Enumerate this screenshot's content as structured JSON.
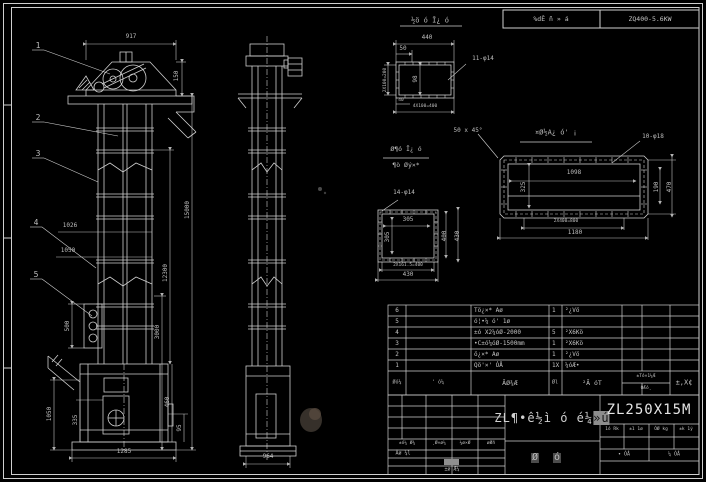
{
  "colors": {
    "background": "#000000",
    "line": "#cfcfcf",
    "dim_text": "#bdbdbd",
    "highlight": "#8d8d8d"
  },
  "header": {
    "left": "%dÊ ñ » á",
    "right": "ZQ400-5.6KW"
  },
  "bom": {
    "headers": {
      "seq": "Øó¼",
      "dwg": "' ó¼",
      "name": "ÃØ¾Æ",
      "qty": "Øl",
      "mat": "²Ã óT",
      "wt": "±Tó×1¼Æ",
      "wt2": "ÓÆó¸",
      "remark": "±,X¢"
    },
    "rows": [
      {
        "seq": "6",
        "dwg": "",
        "name": "Tö¿×* Aø",
        "qty": "1",
        "mat": "²¿Vö"
      },
      {
        "seq": "5",
        "dwg": "",
        "name": "ó¦•¼ ó' 1ø",
        "qty": "",
        "mat": ""
      },
      {
        "seq": "4",
        "dwg": "",
        "name": "±ó X2¼óØ-2000",
        "qty": "5",
        "mat": "²X6Kö"
      },
      {
        "seq": "3",
        "dwg": "",
        "name": "•C±ó¼óØ-1500mm",
        "qty": "1",
        "mat": "²X6Kö"
      },
      {
        "seq": "2",
        "dwg": "",
        "name": "ö¿×* Aø",
        "qty": "1",
        "mat": "²¿Vö"
      },
      {
        "seq": "1",
        "dwg": "",
        "name": "Qö'×' ÓÅ",
        "qty": "1X",
        "mat": "¼óÆ•"
      }
    ]
  },
  "title_block": {
    "machine_name": "ZL¶•ê½ì ó é¼",
    "machine_name_hl": "»ú",
    "model": "ZL250X15M",
    "right_headers": [
      "1ó Rk",
      "±1 1ø",
      "ÓØ kg",
      "±k 1ý"
    ],
    "sheet_left": "• ÓÅ",
    "sheet_right": "¼ ÓÅ",
    "left_headers": [
      "±ó¼ Ø¾",
      "¸Ø×ø¼",
      "¼ø×Ø",
      "øØñ"
    ],
    "row_label": "Ãø ¼l",
    "bottom_label": "±ø Æ¼",
    "assembly_1": "Ø",
    "assembly_2": "ó"
  },
  "annotations": [
    {
      "n": "dim-917",
      "t": "917",
      "x": 131,
      "y": 37
    },
    {
      "n": "dim-150",
      "t": "150",
      "x": 177,
      "y": 76,
      "r": 1
    },
    {
      "n": "dim-1026",
      "t": "1026",
      "x": 70,
      "y": 226
    },
    {
      "n": "dim-1050",
      "t": "1050",
      "x": 68,
      "y": 251
    },
    {
      "n": "dim-15000",
      "t": "15000",
      "x": 188,
      "y": 210,
      "r": 1
    },
    {
      "n": "dim-12300",
      "t": "12300",
      "x": 166,
      "y": 273,
      "r": 1
    },
    {
      "n": "dim-3000",
      "t": "3000",
      "x": 158,
      "y": 332,
      "r": 1
    },
    {
      "n": "dim-500",
      "t": "500",
      "x": 68,
      "y": 326,
      "r": 1
    },
    {
      "n": "dim-1050-boot",
      "t": "1050",
      "x": 50,
      "y": 414,
      "r": 1
    },
    {
      "n": "dim-335",
      "t": "335",
      "x": 76,
      "y": 420,
      "r": 1
    },
    {
      "n": "dim-460",
      "t": "460",
      "x": 168,
      "y": 402,
      "r": 1
    },
    {
      "n": "dim-95",
      "t": "95",
      "x": 180,
      "y": 428,
      "r": 1
    },
    {
      "n": "dim-1285",
      "t": "1285",
      "x": 124,
      "y": 452
    },
    {
      "n": "balloon-1",
      "t": "1",
      "x": 38,
      "y": 46,
      "s": 8
    },
    {
      "n": "balloon-2",
      "t": "2",
      "x": 38,
      "y": 118,
      "s": 8
    },
    {
      "n": "balloon-3",
      "t": "3",
      "x": 38,
      "y": 154,
      "s": 8
    },
    {
      "n": "balloon-4",
      "t": "4",
      "x": 36,
      "y": 223,
      "s": 8
    },
    {
      "n": "balloon-5",
      "t": "5",
      "x": 36,
      "y": 275,
      "s": 8
    },
    {
      "n": "dim-964",
      "t": "964",
      "x": 268,
      "y": 457
    },
    {
      "n": "detail-a-title",
      "t": "½ö ó Ī¿ ó",
      "x": 430,
      "y": 21,
      "s": 7
    },
    {
      "n": "dim-440",
      "t": "440",
      "x": 427,
      "y": 38
    },
    {
      "n": "dim-50",
      "t": "50",
      "x": 403,
      "y": 49
    },
    {
      "n": "label-11-phi14",
      "t": "11-φ14",
      "x": 483,
      "y": 59
    },
    {
      "n": "dim-98",
      "t": "98",
      "x": 416,
      "y": 79,
      "r": 1
    },
    {
      "n": "dim-2x100",
      "t": "2X100=200",
      "x": 386,
      "y": 80,
      "r": 1,
      "s": 4.5
    },
    {
      "n": "dim-40",
      "t": "40",
      "x": 401,
      "y": 101,
      "s": 4.5
    },
    {
      "n": "dim-4x100",
      "t": "4X100=400",
      "x": 425,
      "y": 107,
      "s": 4.5
    },
    {
      "n": "note-chamfer",
      "t": "50 x 45°",
      "x": 468,
      "y": 131
    },
    {
      "n": "detail-b-title",
      "t": "¤Ø½A¿ ó' ¡",
      "x": 556,
      "y": 133,
      "s": 7
    },
    {
      "n": "label-10-phi18",
      "t": "10-φ18",
      "x": 653,
      "y": 137
    },
    {
      "n": "dim-1098",
      "t": "1098",
      "x": 574,
      "y": 173
    },
    {
      "n": "dim-325",
      "t": "325",
      "x": 524,
      "y": 187,
      "r": 1
    },
    {
      "n": "dim-190",
      "t": "190",
      "x": 657,
      "y": 187,
      "r": 1
    },
    {
      "n": "dim-470",
      "t": "470",
      "x": 670,
      "y": 187,
      "r": 1
    },
    {
      "n": "dim-2x400",
      "t": "2X400=800",
      "x": 566,
      "y": 222,
      "s": 4.5
    },
    {
      "n": "dim-1180",
      "t": "1180",
      "x": 575,
      "y": 233
    },
    {
      "n": "detail-c-title-1",
      "t": "Ø¶ó Ī¿ ó",
      "x": 406,
      "y": 149,
      "s": 6.5
    },
    {
      "n": "detail-c-title-2",
      "t": "¶ò Øý×*",
      "x": 406,
      "y": 165,
      "s": 6.5
    },
    {
      "n": "label-14-phi14",
      "t": "14-φ14",
      "x": 404,
      "y": 193
    },
    {
      "n": "dim-305-h",
      "t": "305",
      "x": 408,
      "y": 220
    },
    {
      "n": "dim-305-v",
      "t": "305",
      "x": 388,
      "y": 237,
      "r": 1
    },
    {
      "n": "dim-400",
      "t": "400",
      "x": 445,
      "y": 236,
      "r": 1
    },
    {
      "n": "dim-430-right",
      "t": "430",
      "x": 458,
      "y": 236,
      "r": 1
    },
    {
      "n": "dim-2x161",
      "t": "2X161.5=400",
      "x": 408,
      "y": 266,
      "s": 4.5
    },
    {
      "n": "dim-430-bottom",
      "t": "430",
      "x": 408,
      "y": 275
    }
  ]
}
